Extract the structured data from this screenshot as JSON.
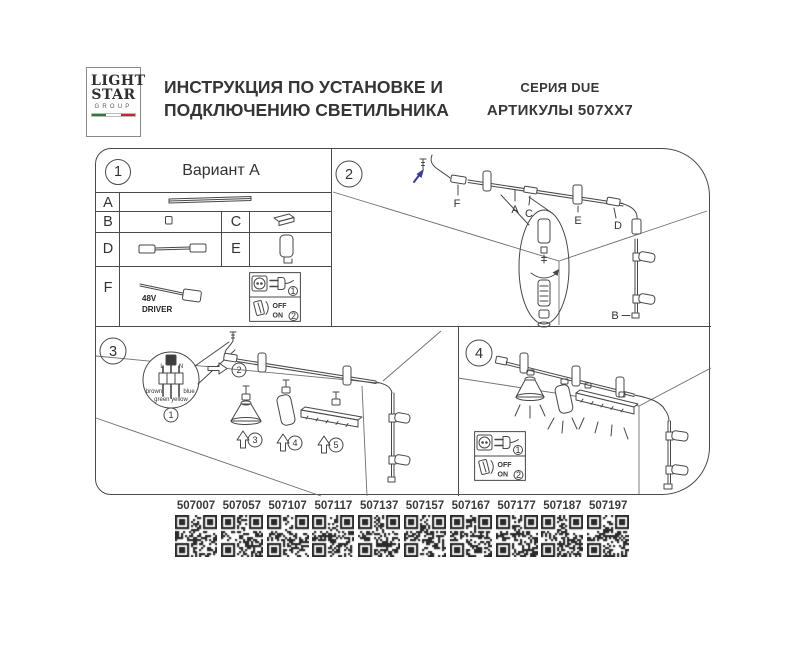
{
  "header": {
    "logo_line1": "LIGHT",
    "logo_line2": "STAR",
    "logo_line3": "GROUP",
    "title_line1": "ИНСТРУКЦИЯ ПО УСТАНОВКЕ И",
    "title_line2": "ПОДКЛЮЧЕНИЮ СВЕТИЛЬНИКА",
    "series": "СЕРИЯ DUE",
    "articles": "АРТИКУЛЫ 507XX7"
  },
  "sections": {
    "s1": {
      "number": "1",
      "title": "Вариант А",
      "row_a": "A",
      "row_b": "B",
      "row_c": "C",
      "row_d": "D",
      "row_e": "E",
      "row_f": "F",
      "driver_line1": "48V",
      "driver_line2": "DRIVER"
    },
    "s2": {
      "number": "2",
      "label_f": "F",
      "label_a": "A",
      "label_c": "C",
      "label_e": "E",
      "label_d": "D",
      "label_b": "B"
    },
    "s3": {
      "number": "3",
      "wire_l": "L",
      "wire_n": "N",
      "wire_brown": "brown",
      "wire_blue": "blue",
      "wire_green_yellow": "green yellow",
      "step1": "1",
      "step2": "2",
      "step3": "3",
      "step4": "4",
      "step5": "5"
    },
    "s4": {
      "number": "4"
    }
  },
  "power_steps": {
    "plug_step": "1",
    "switch_step": "2",
    "off": "OFF",
    "on": "ON"
  },
  "qr_codes": [
    {
      "code": "507007"
    },
    {
      "code": "507057"
    },
    {
      "code": "507107"
    },
    {
      "code": "507117"
    },
    {
      "code": "507137"
    },
    {
      "code": "507157"
    },
    {
      "code": "507167"
    },
    {
      "code": "507177"
    },
    {
      "code": "507187"
    },
    {
      "code": "507197"
    }
  ],
  "colors": {
    "line": "#474747",
    "accent_blue": "#3a3f92",
    "flag_green": "#2f7a33",
    "flag_red": "#bf2b2b"
  }
}
